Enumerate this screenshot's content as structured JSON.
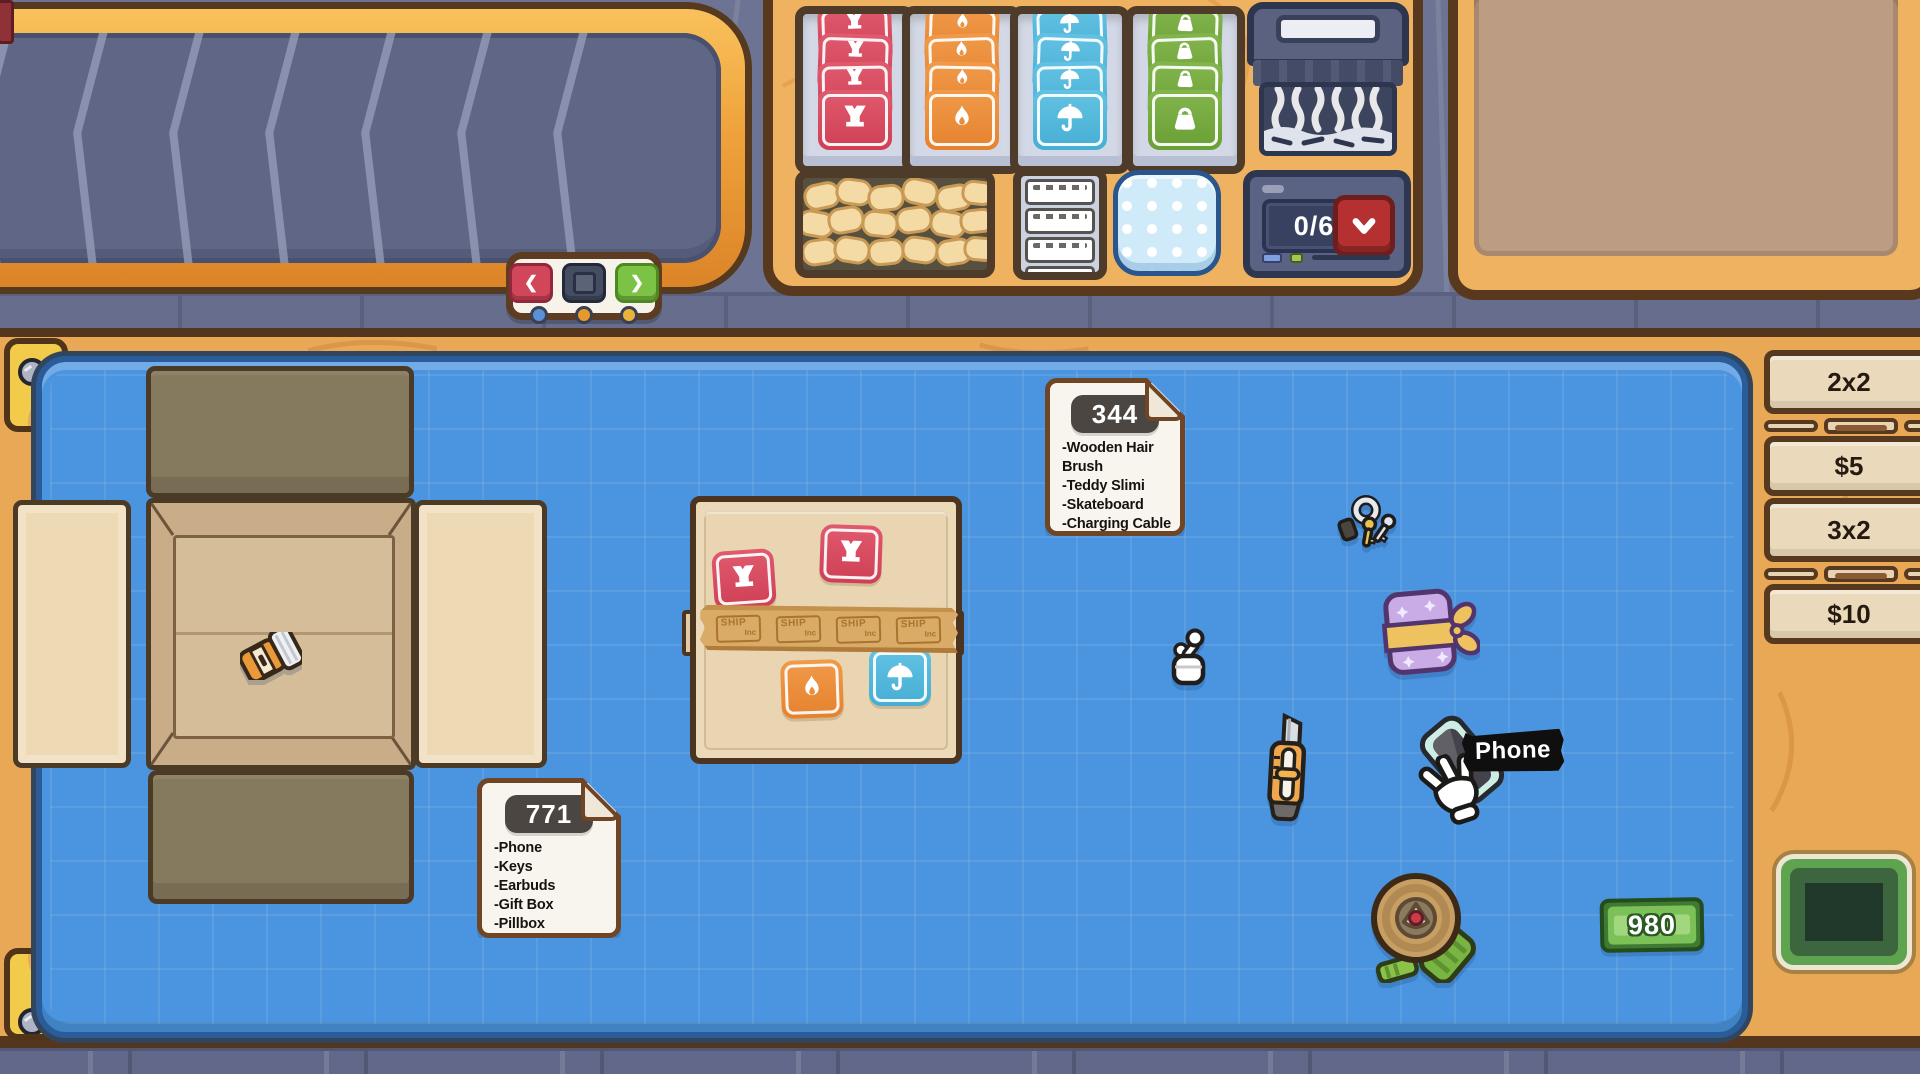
{
  "nav": {
    "prev_icon": "❮",
    "next_icon": "❯"
  },
  "machines": {
    "counter_value": "0/6"
  },
  "orders": [
    {
      "id": "344",
      "items": [
        "-Wooden Hair Brush",
        "-Teddy Slimi",
        "-Skateboard",
        "-Charging Cable",
        "-Powerbank"
      ]
    },
    {
      "id": "771",
      "items": [
        "-Phone",
        "-Keys",
        "-Earbuds",
        "-Gift Box",
        "-Pillbox"
      ]
    }
  ],
  "tape": {
    "brand": "SHIP",
    "brand_sub": "Inc"
  },
  "tooltip": {
    "label": "Phone"
  },
  "money": {
    "amount": "980"
  },
  "box_options": [
    {
      "size": "2x2",
      "price": "$5"
    },
    {
      "size": "3x2",
      "price": "$10"
    }
  ],
  "icons": {
    "fragile": "broken-glass",
    "flammable": "flame",
    "keep_dry": "umbrella",
    "heavy": "weight",
    "confirm": "chevron-down",
    "stop": "square",
    "shredder": "shredder",
    "cursor": "hand-grab"
  },
  "palette": {
    "fragile": "#d84a5f",
    "flammable": "#e8893a",
    "keep_dry": "#56b8dc",
    "heavy": "#76aa42",
    "mat_blue": "#4b94df",
    "wood": "#eeb261",
    "money_green": "#7cc158",
    "confirm_red": "#b53131"
  }
}
